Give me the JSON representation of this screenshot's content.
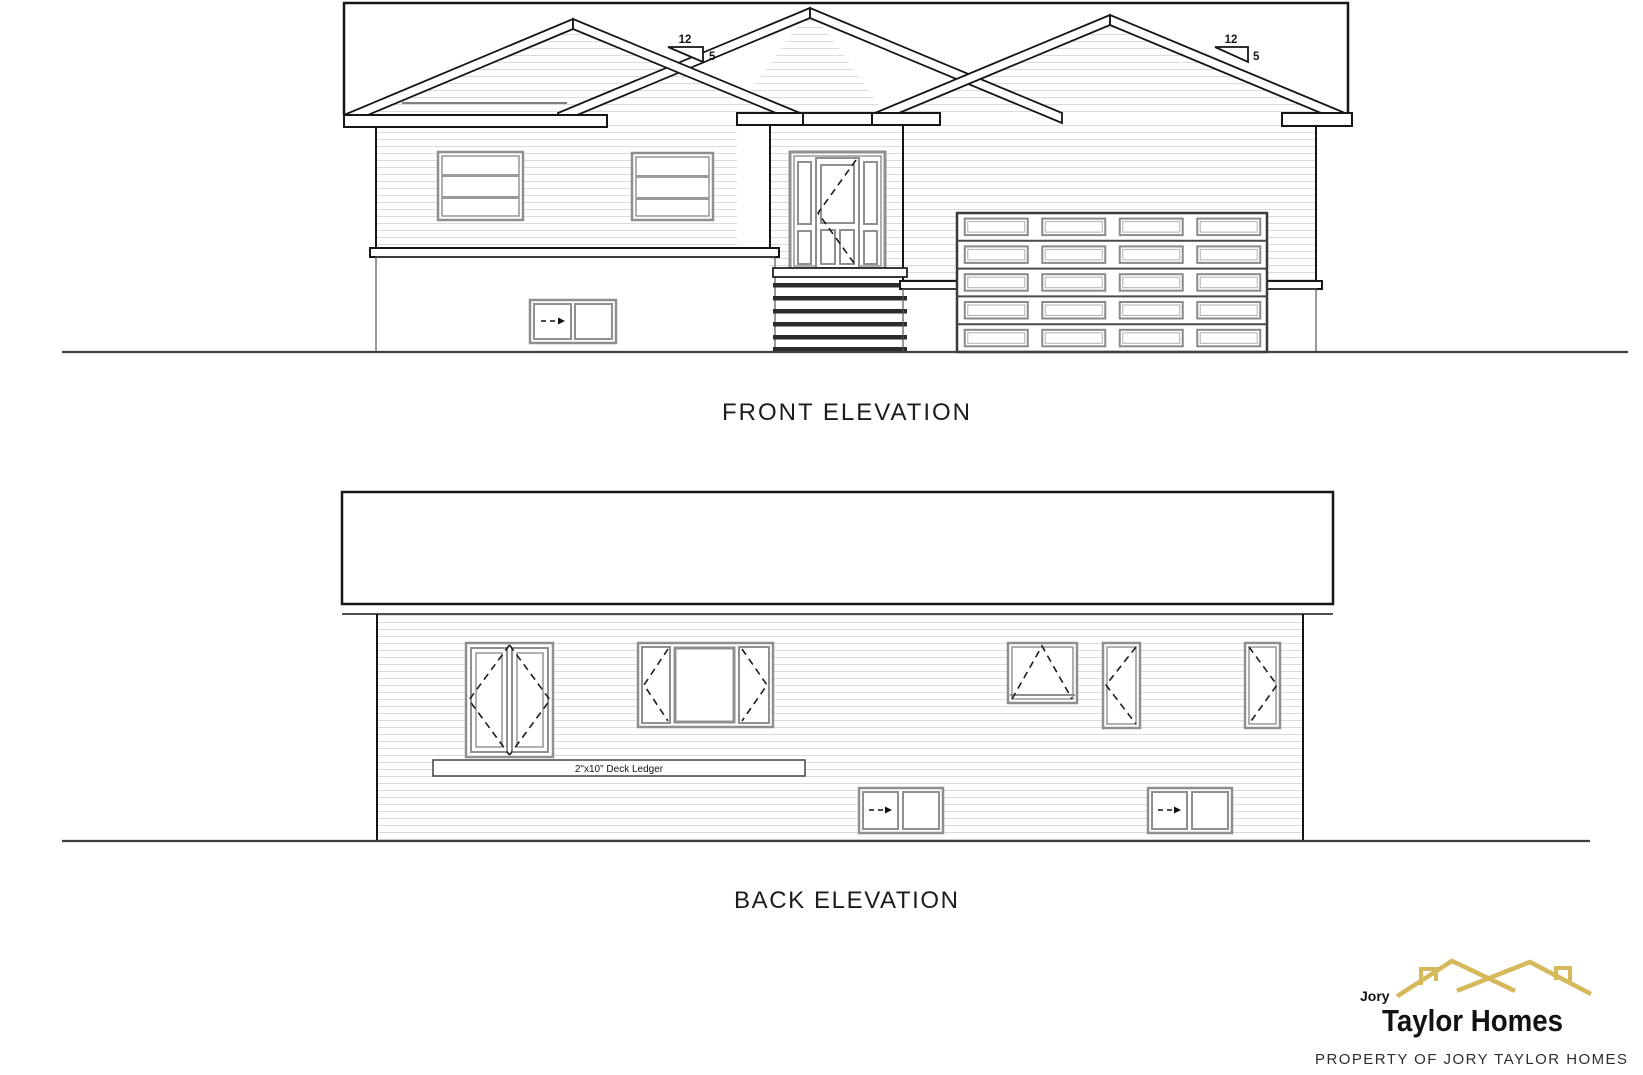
{
  "front_elevation": {
    "label": "FRONT ELEVATION",
    "pitch_markers": [
      {
        "rise": "12",
        "run": "5"
      },
      {
        "rise": "12",
        "run": "5"
      }
    ]
  },
  "back_elevation": {
    "label": "BACK ELEVATION",
    "deck_ledger_label": "2\"x10\" Deck Ledger"
  },
  "branding": {
    "logo_small_text": "Jory",
    "logo_main_text": "Taylor Homes",
    "logo_color": "#d5b95a",
    "footer_notice": "PROPERTY OF JORY TAYLOR HOMES"
  }
}
